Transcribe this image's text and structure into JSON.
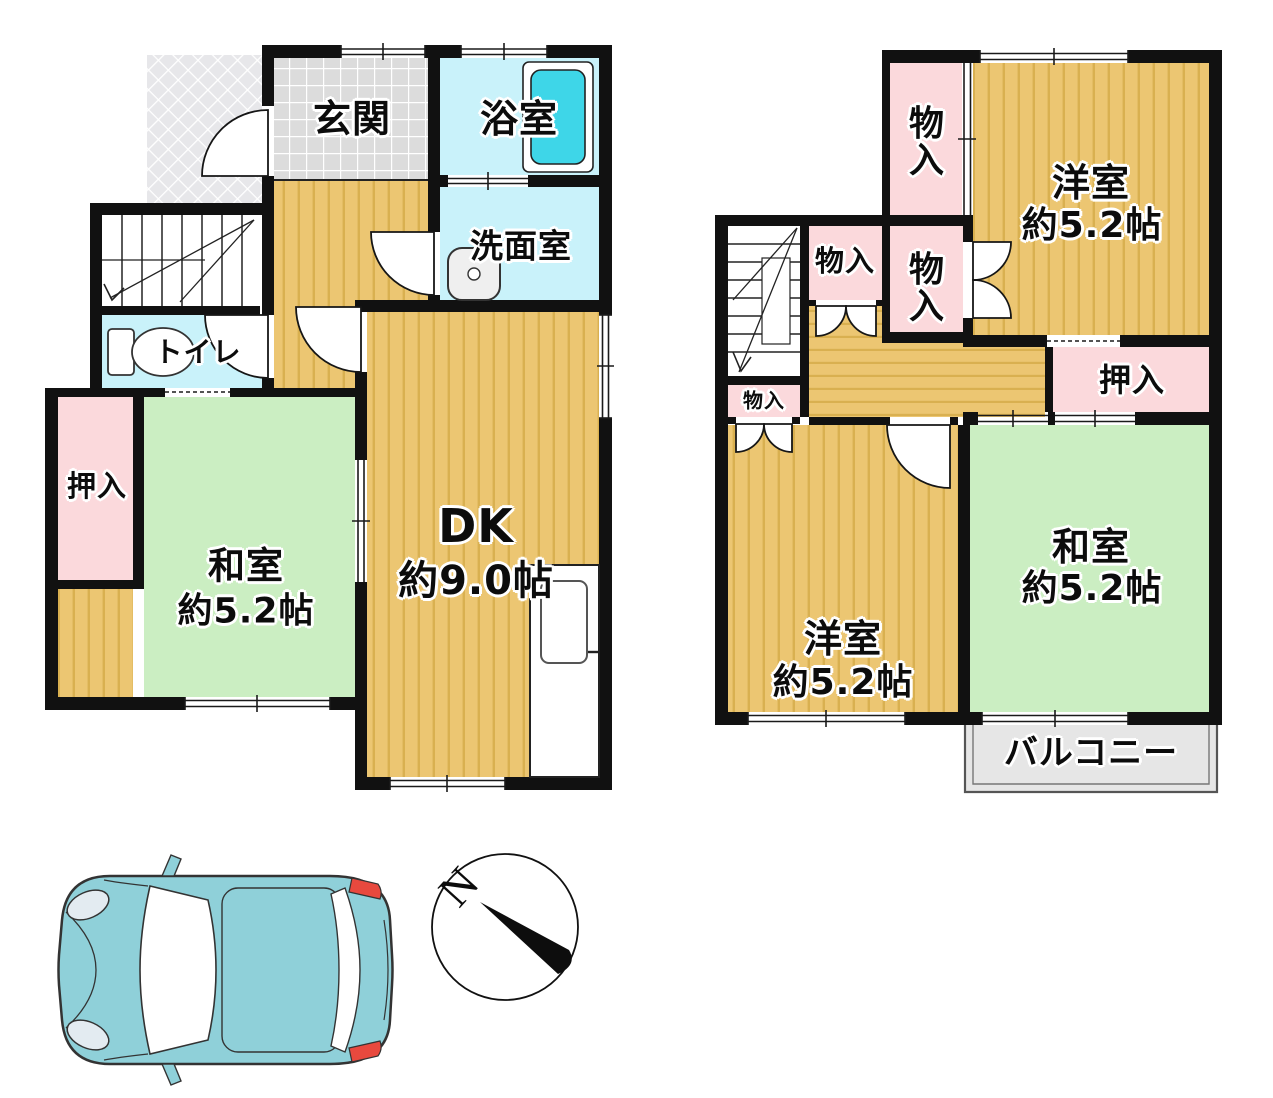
{
  "floor1": {
    "rooms": {
      "entrance": {
        "label": "玄関"
      },
      "bathroom": {
        "label": "浴室"
      },
      "washroom": {
        "label": "洗面室"
      },
      "toilet": {
        "label": "トイレ"
      },
      "closet": {
        "label": "押入"
      },
      "washitsu": {
        "name": "和室",
        "size": "約5.2帖"
      },
      "dk": {
        "name": "DK",
        "size": "約9.0帖"
      }
    }
  },
  "floor2": {
    "rooms": {
      "storage_top": {
        "label": "物入"
      },
      "storage_mid_left": {
        "label": "物入"
      },
      "storage_mid": {
        "label": "物入"
      },
      "storage_small": {
        "label": "物入"
      },
      "oshiire": {
        "label": "押入"
      },
      "yoshitsu_top": {
        "name": "洋室",
        "size": "約5.2帖"
      },
      "yoshitsu_bottom": {
        "name": "洋室",
        "size": "約5.2帖"
      },
      "washitsu": {
        "name": "和室",
        "size": "約5.2帖"
      },
      "balcony": {
        "label": "バルコニー"
      }
    }
  },
  "compass": {
    "north_label": "N"
  },
  "colors": {
    "wall": "#111111",
    "wood_floor": "#ecc672",
    "wood_stripe": "#d9b050",
    "tatami_green": "#cbeec2",
    "closet_pink": "#fbd9dc",
    "wet_area_cyan": "#c9f2fa",
    "bathtub_cyan": "#3ed6e8",
    "entrance_tile": "#dcdcdc",
    "balcony_gray": "#e6e6e6",
    "car_body_teal": "#8fd0d9",
    "taillight_red": "#e8493e"
  }
}
